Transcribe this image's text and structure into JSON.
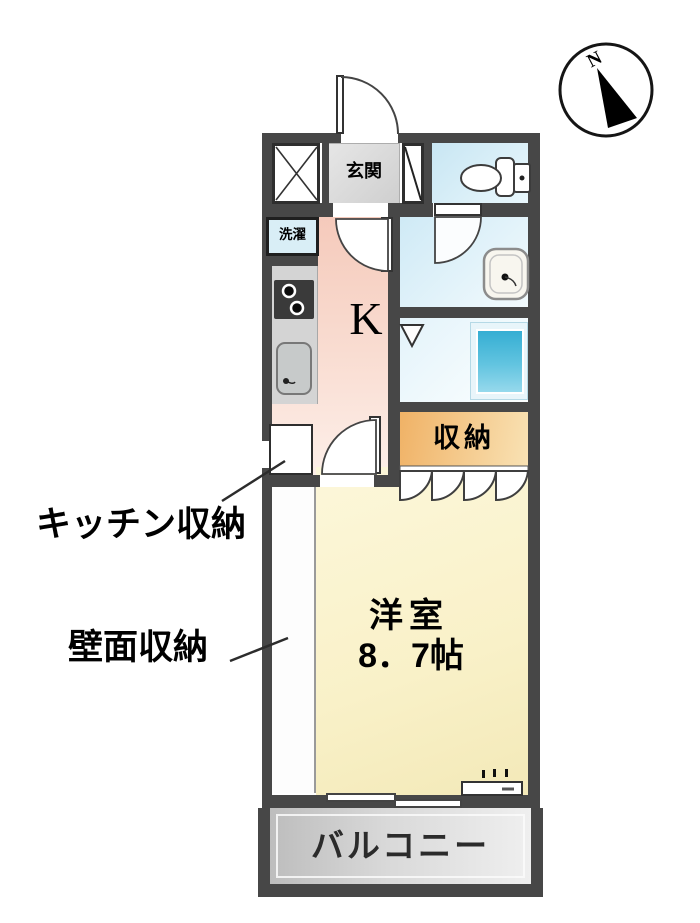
{
  "plan": {
    "compass": {
      "north_label": "N"
    },
    "rooms": {
      "entrance": "玄関",
      "laundry": "洗濯",
      "kitchen": "K",
      "storage": "収納",
      "western_room_name": "洋室",
      "western_room_size": "8．7帖",
      "balcony": "バルコニー"
    },
    "annotations": {
      "kitchen_storage": "キッチン収納",
      "wall_storage": "壁面収納"
    },
    "colors": {
      "wall": "#474747",
      "kitchen_floor": "#f5c9ba",
      "western_room_floor": "#f9f1c8",
      "storage_fill": "#f0b266",
      "wet_area_floor": "#cfeaf6",
      "bath_unit_blue": "#35aed3",
      "balcony_gray": "#cccccc"
    }
  }
}
